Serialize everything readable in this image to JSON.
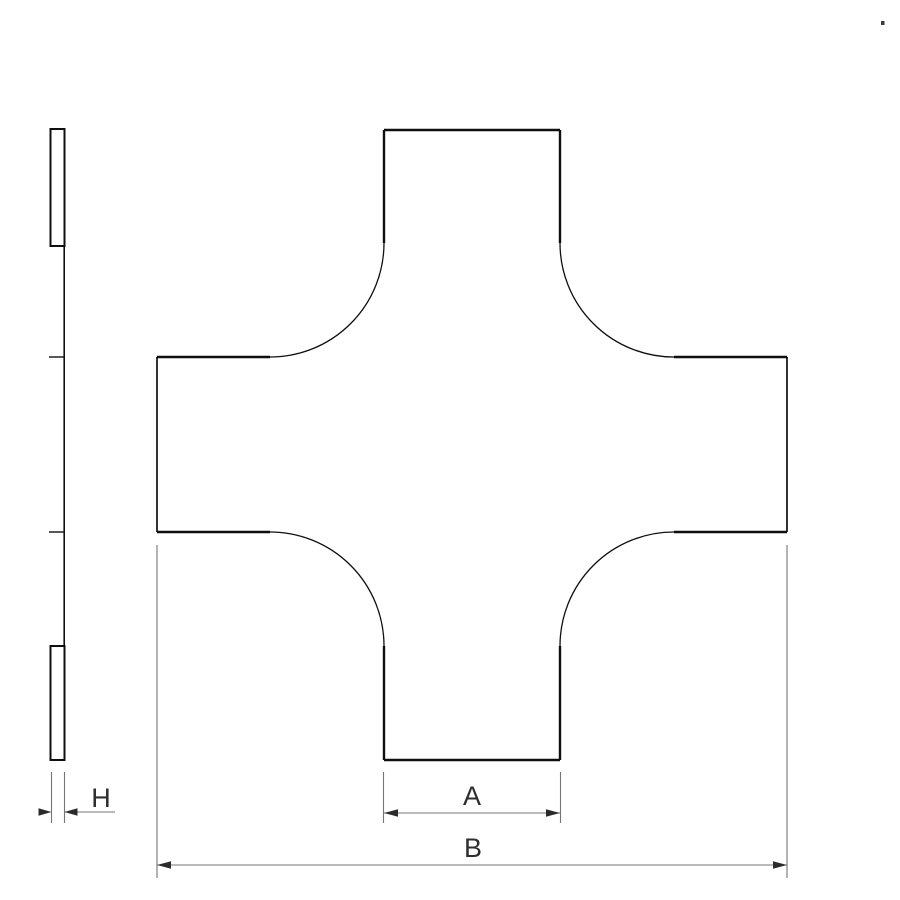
{
  "drawing": {
    "title": "cross-fitting technical drawing",
    "labels": {
      "inner_width": "A",
      "overall_width": "B",
      "thickness": "H"
    },
    "colors": {
      "background": "#ffffff",
      "outline": "#0f0f0f",
      "dimension_line": "#757575",
      "arrowhead": "#2b2b2b",
      "label_text": "#2e2e2e"
    }
  }
}
